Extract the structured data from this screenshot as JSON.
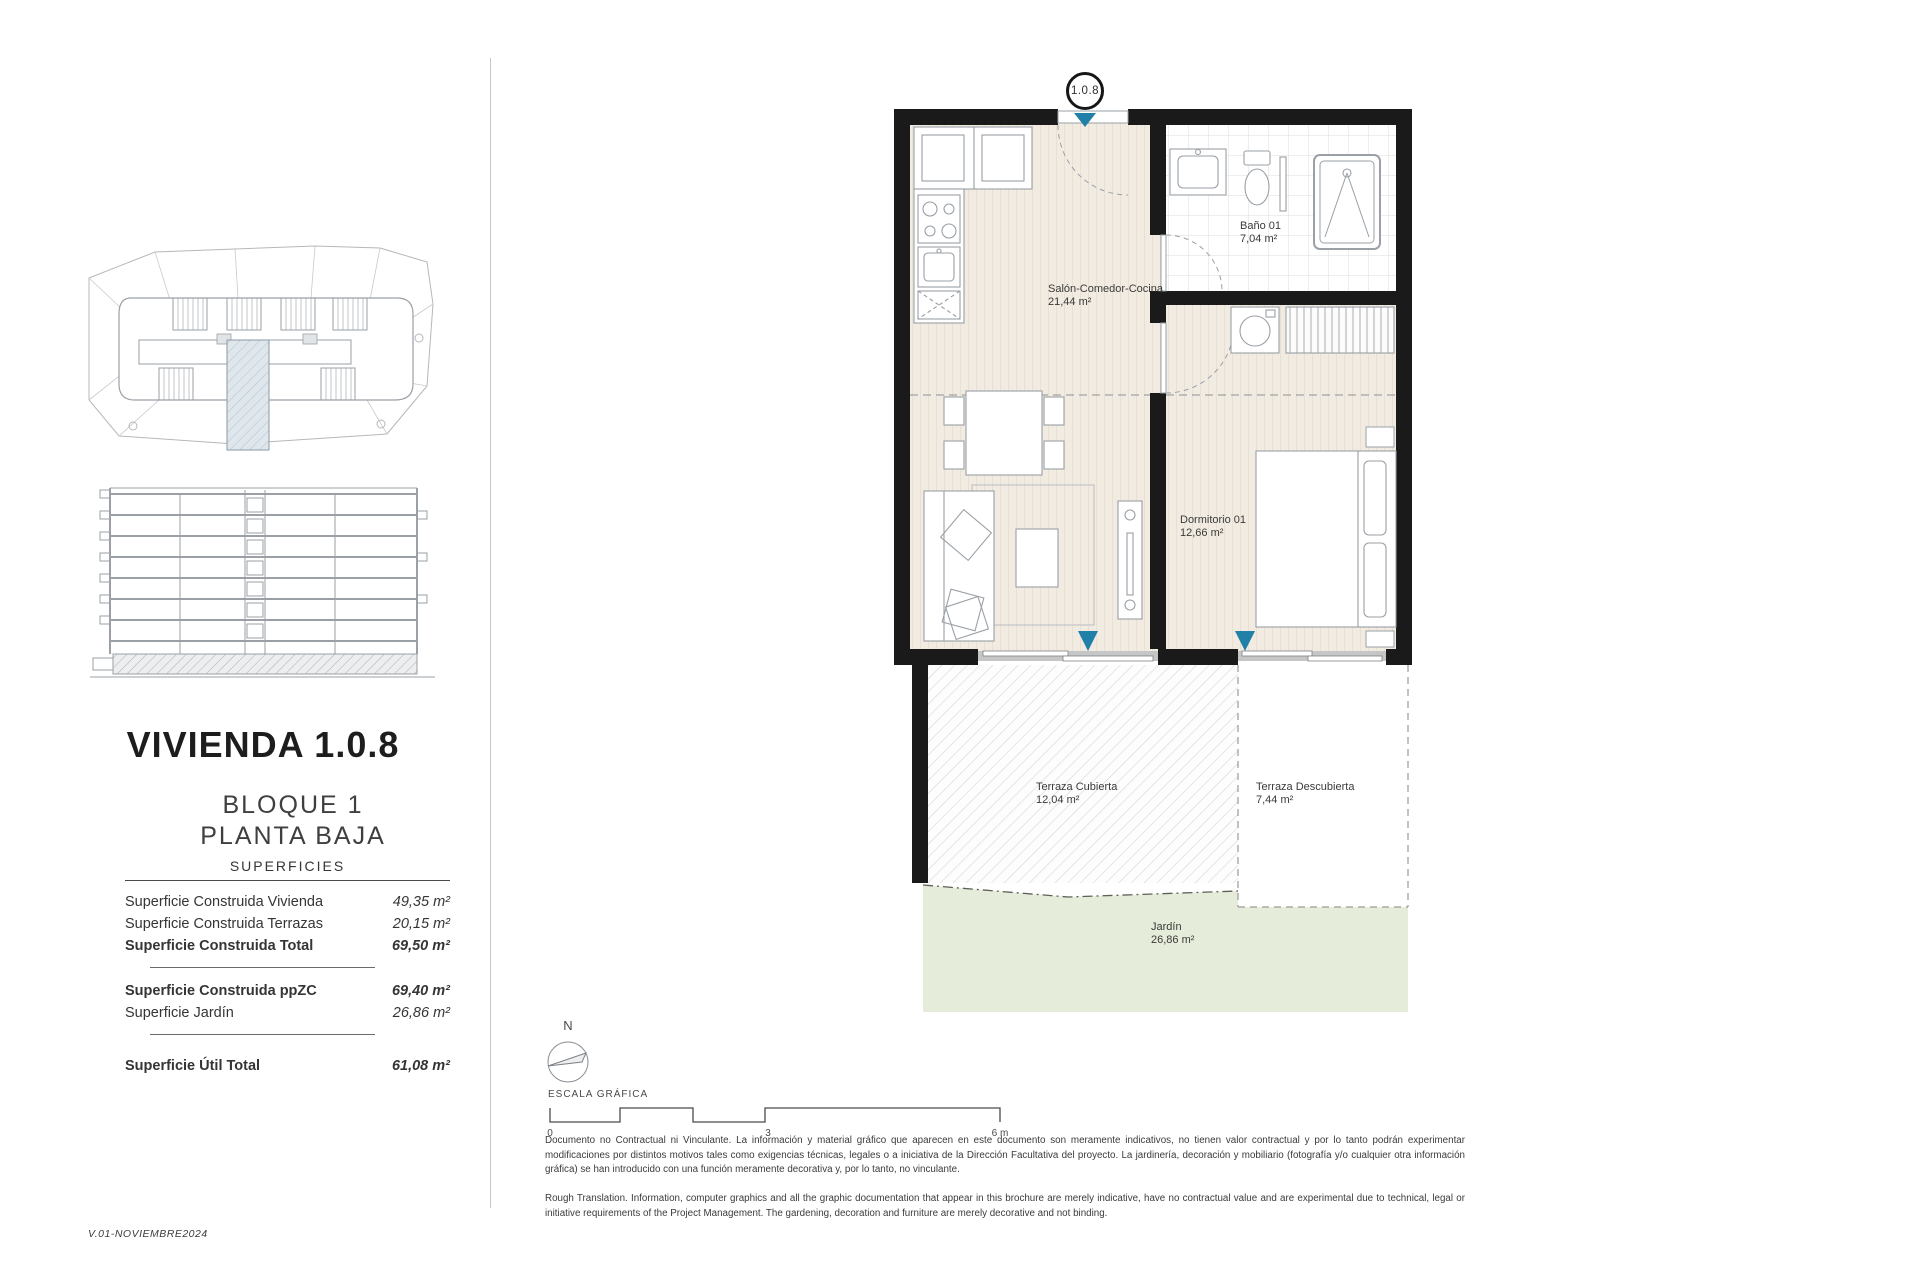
{
  "page": {
    "version": "V.01-NOVIEMBRE2024"
  },
  "sidebar": {
    "title": "VIVIENDA 1.0.8",
    "block": "BLOQUE 1",
    "floor": "PLANTA BAJA",
    "surfaces": {
      "header": "SUPERFICIES",
      "rows": [
        {
          "label": "Superficie Construida Vivienda",
          "value": "49,35 m²"
        },
        {
          "label": "Superficie Construida Terrazas",
          "value": "20,15 m²"
        },
        {
          "label": "Superficie Construida Total",
          "value": "69,50 m²"
        },
        {
          "label": "Superficie Construida ppZC",
          "value": "69,40 m²"
        },
        {
          "label": "Superficie Jardín",
          "value": "26,86 m²"
        },
        {
          "label": "Superficie Útil Total",
          "value": "61,08 m²"
        }
      ]
    }
  },
  "plan": {
    "unit_marker": "1.0.8",
    "rooms": {
      "salon": {
        "name": "Salón-Comedor-Cocina",
        "area": "21,44 m²"
      },
      "bano": {
        "name": "Baño 01",
        "area": "7,04 m²"
      },
      "dormitorio": {
        "name": "Dormitorio 01",
        "area": "12,66 m²"
      },
      "terraza_cubierta": {
        "name": "Terraza Cubierta",
        "area": "12,04 m²"
      },
      "terraza_descubierta": {
        "name": "Terraza Descubierta",
        "area": "7,44 m²"
      },
      "jardin": {
        "name": "Jardín",
        "area": "26,86 m²"
      }
    }
  },
  "legend": {
    "north": "N",
    "scale_label": "ESCALA GRÁFICA",
    "scale_ticks": [
      "0",
      "3",
      "6 m"
    ]
  },
  "footnotes": {
    "spanish": "Documento no Contractual ni Vinculante. La información y material gráfico que aparecen en este documento son meramente indicativos, no tienen valor contractual y por lo tanto podrán experimentar modificaciones por distintos motivos tales como exigencias técnicas, legales o a iniciativa de la Dirección Facultativa del proyecto. La jardinería, decoración y mobiliario (fotografía y/o cualquier otra información gráfica) se han introducido con una función meramente decorativa y, por lo tanto, no vinculante.",
    "english": "Rough Translation. Information, computer graphics and all the graphic documentation that appear in this brochure are merely indicative, have no contractual value and are experimental due to technical, legal or initiative requirements of the Project Management. The gardening, decoration and furniture are merely decorative and not binding."
  },
  "colors": {
    "wall": "#1a1a1a",
    "accent_teal": "#2080a8",
    "floor_beige": "#f1ebe2",
    "garden_green": "#e6ecda",
    "line_gray": "#9aa0a6"
  }
}
